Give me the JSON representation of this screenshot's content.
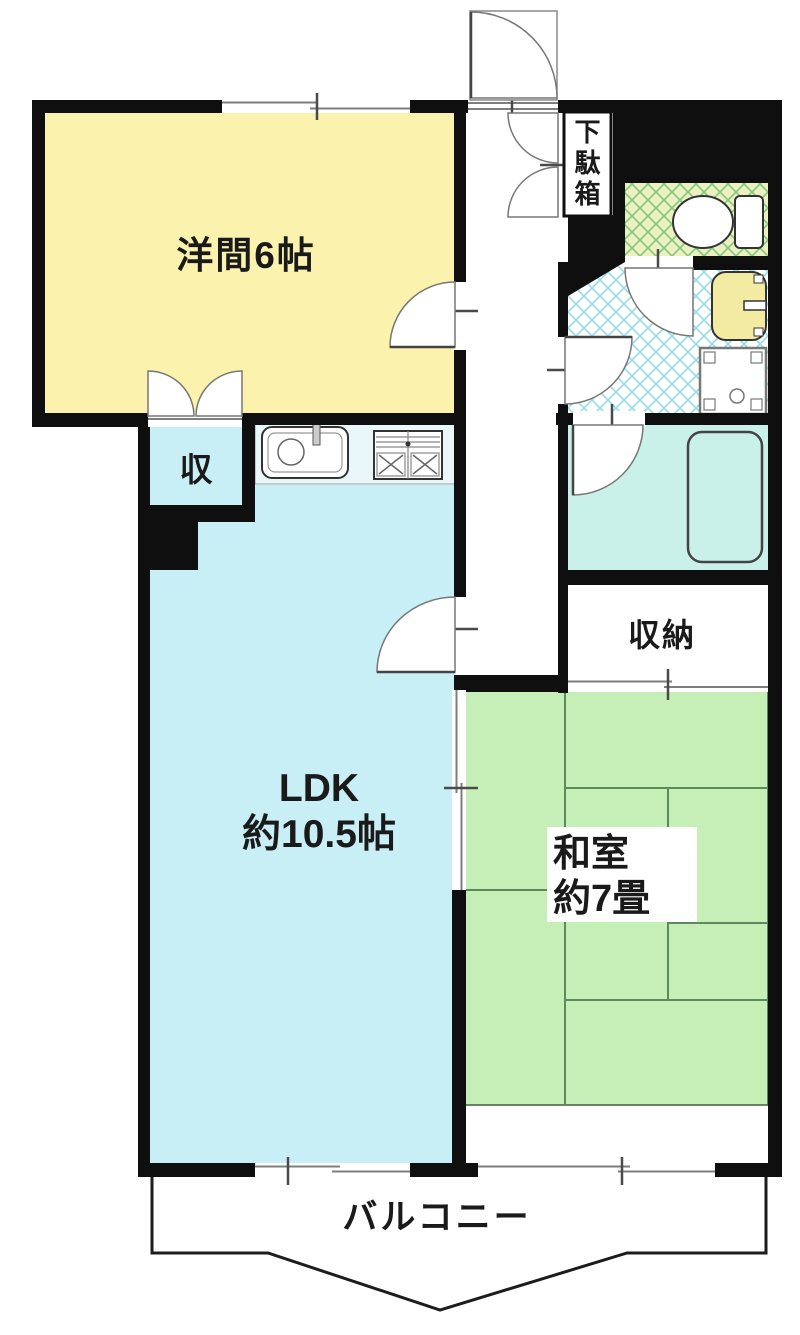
{
  "title": "マンション間取り図",
  "rooms": {
    "western": {
      "label": "洋間6帖",
      "color": "#faf2ad"
    },
    "ldk": {
      "label1": "LDK",
      "label2": "約10.5帖",
      "color": "#c8eef6"
    },
    "washitsu": {
      "label1": "和室",
      "label2": "約7畳",
      "color": "#c5efb6"
    },
    "storage_shu": {
      "label": "収",
      "color": "#c8eef6"
    },
    "shuno": {
      "label": "収納",
      "color": "#ffffff"
    },
    "getabako": {
      "chars": [
        "下",
        "駄",
        "箱"
      ]
    },
    "balcony": {
      "label": "バルコニー"
    },
    "toilet": {
      "floor_base": "#edefc0",
      "lattice": "#7cc87c"
    },
    "washroom": {
      "floor_base": "#ffffff",
      "lattice": "#94dce7"
    },
    "bathroom": {
      "color": "#c9f1e9"
    },
    "kitchen": {
      "counter_color": "#e9f6fa"
    }
  },
  "fixtures": {
    "washbasin_color": "#f3eba2",
    "icons": [
      "toilet-icon",
      "washbasin-icon",
      "washing-machine-pan-icon",
      "bathtub-icon",
      "kitchen-sink-icon",
      "kitchen-stove-icon"
    ]
  },
  "colors": {
    "walls": "#0f0f0f",
    "window_line": "#7d7d7d",
    "balcony_line": "#1c1c1c",
    "tatami_line": "#5d8a5d"
  }
}
